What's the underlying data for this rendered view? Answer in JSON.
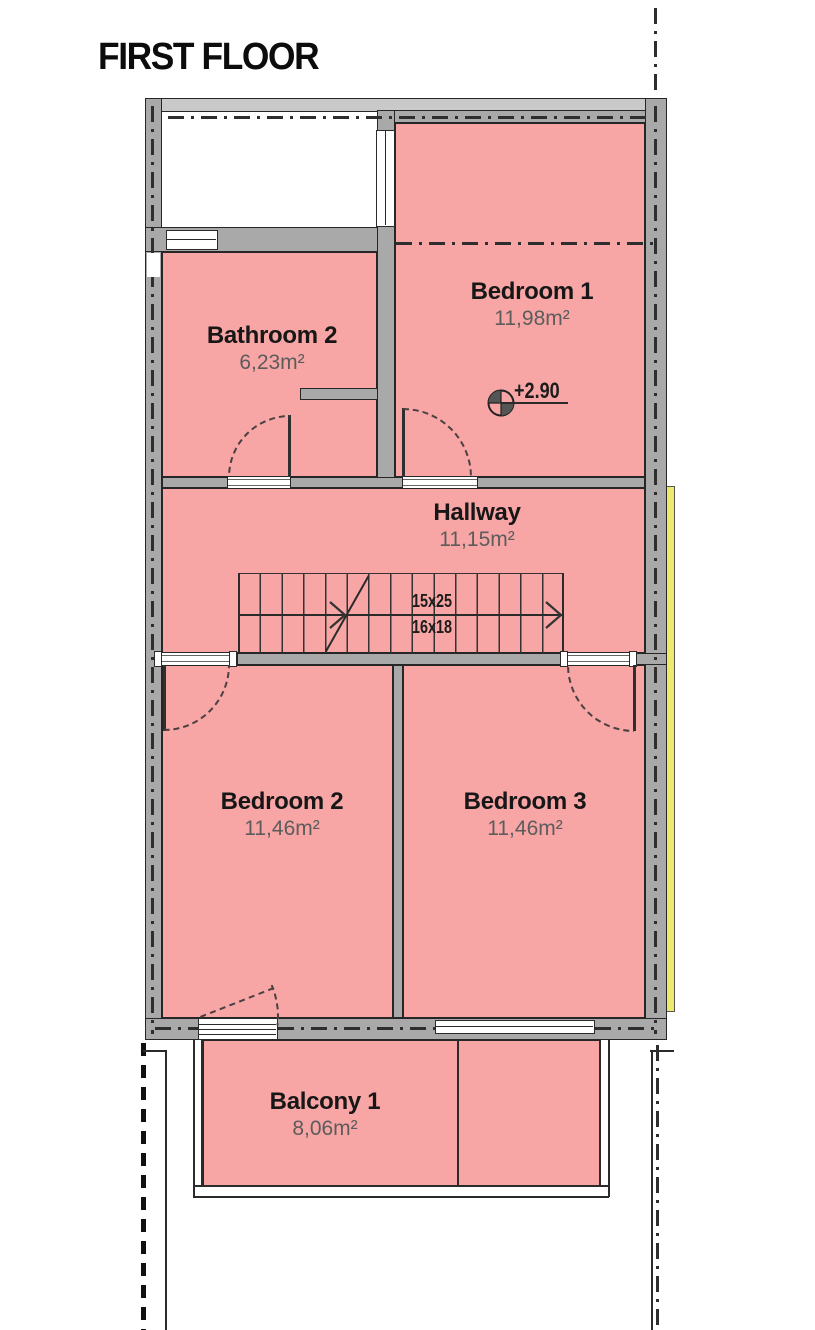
{
  "title": "FIRST FLOOR",
  "rooms": {
    "bathroom2": {
      "name": "Bathroom 2",
      "area": "6,23m²"
    },
    "bedroom1": {
      "name": "Bedroom 1",
      "area": "11,98m²"
    },
    "hallway": {
      "name": "Hallway",
      "area": "11,15m²"
    },
    "bedroom2": {
      "name": "Bedroom 2",
      "area": "11,46m²"
    },
    "bedroom3": {
      "name": "Bedroom 3",
      "area": "11,46m²"
    },
    "balcony1": {
      "name": "Balcony 1",
      "area": "8,06m²"
    }
  },
  "annotations": {
    "level_marker": "+2.90",
    "stair_dimensions": [
      "15x25",
      "16x18"
    ]
  },
  "colors": {
    "room_fill": "#f7a5a5",
    "wall_fill": "#a9a9a9",
    "wall_edge": "#262626",
    "accent_strip": "#eeea6d",
    "label_text": "#171717",
    "area_text": "#5c5c5c"
  }
}
